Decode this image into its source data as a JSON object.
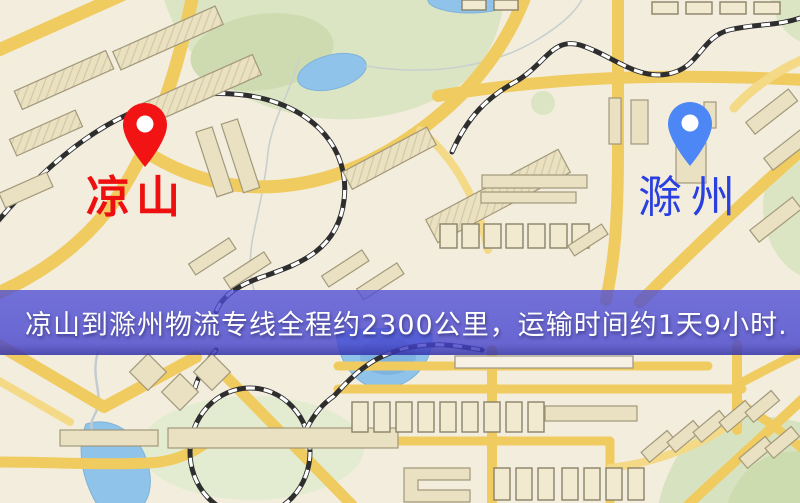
{
  "map": {
    "origin": {
      "name": "凉山",
      "pin_icon": "map-pin",
      "pin_color": "#f21414",
      "label_color": "#ee1010"
    },
    "destination": {
      "name": "滁州",
      "pin_icon": "map-pin",
      "pin_color": "#4d87f5",
      "label_color": "#2a3fe0"
    },
    "banner": {
      "text": "凉山到滁州物流专线全程约2300公里，运输时间约1天9小时.",
      "background": "#4a4ace",
      "text_color": "#ffffff"
    },
    "map_colors": {
      "background": "#f3edde",
      "road": "#f0cb5f",
      "park": "#dce5c3",
      "water": "#8fc3e9"
    }
  }
}
